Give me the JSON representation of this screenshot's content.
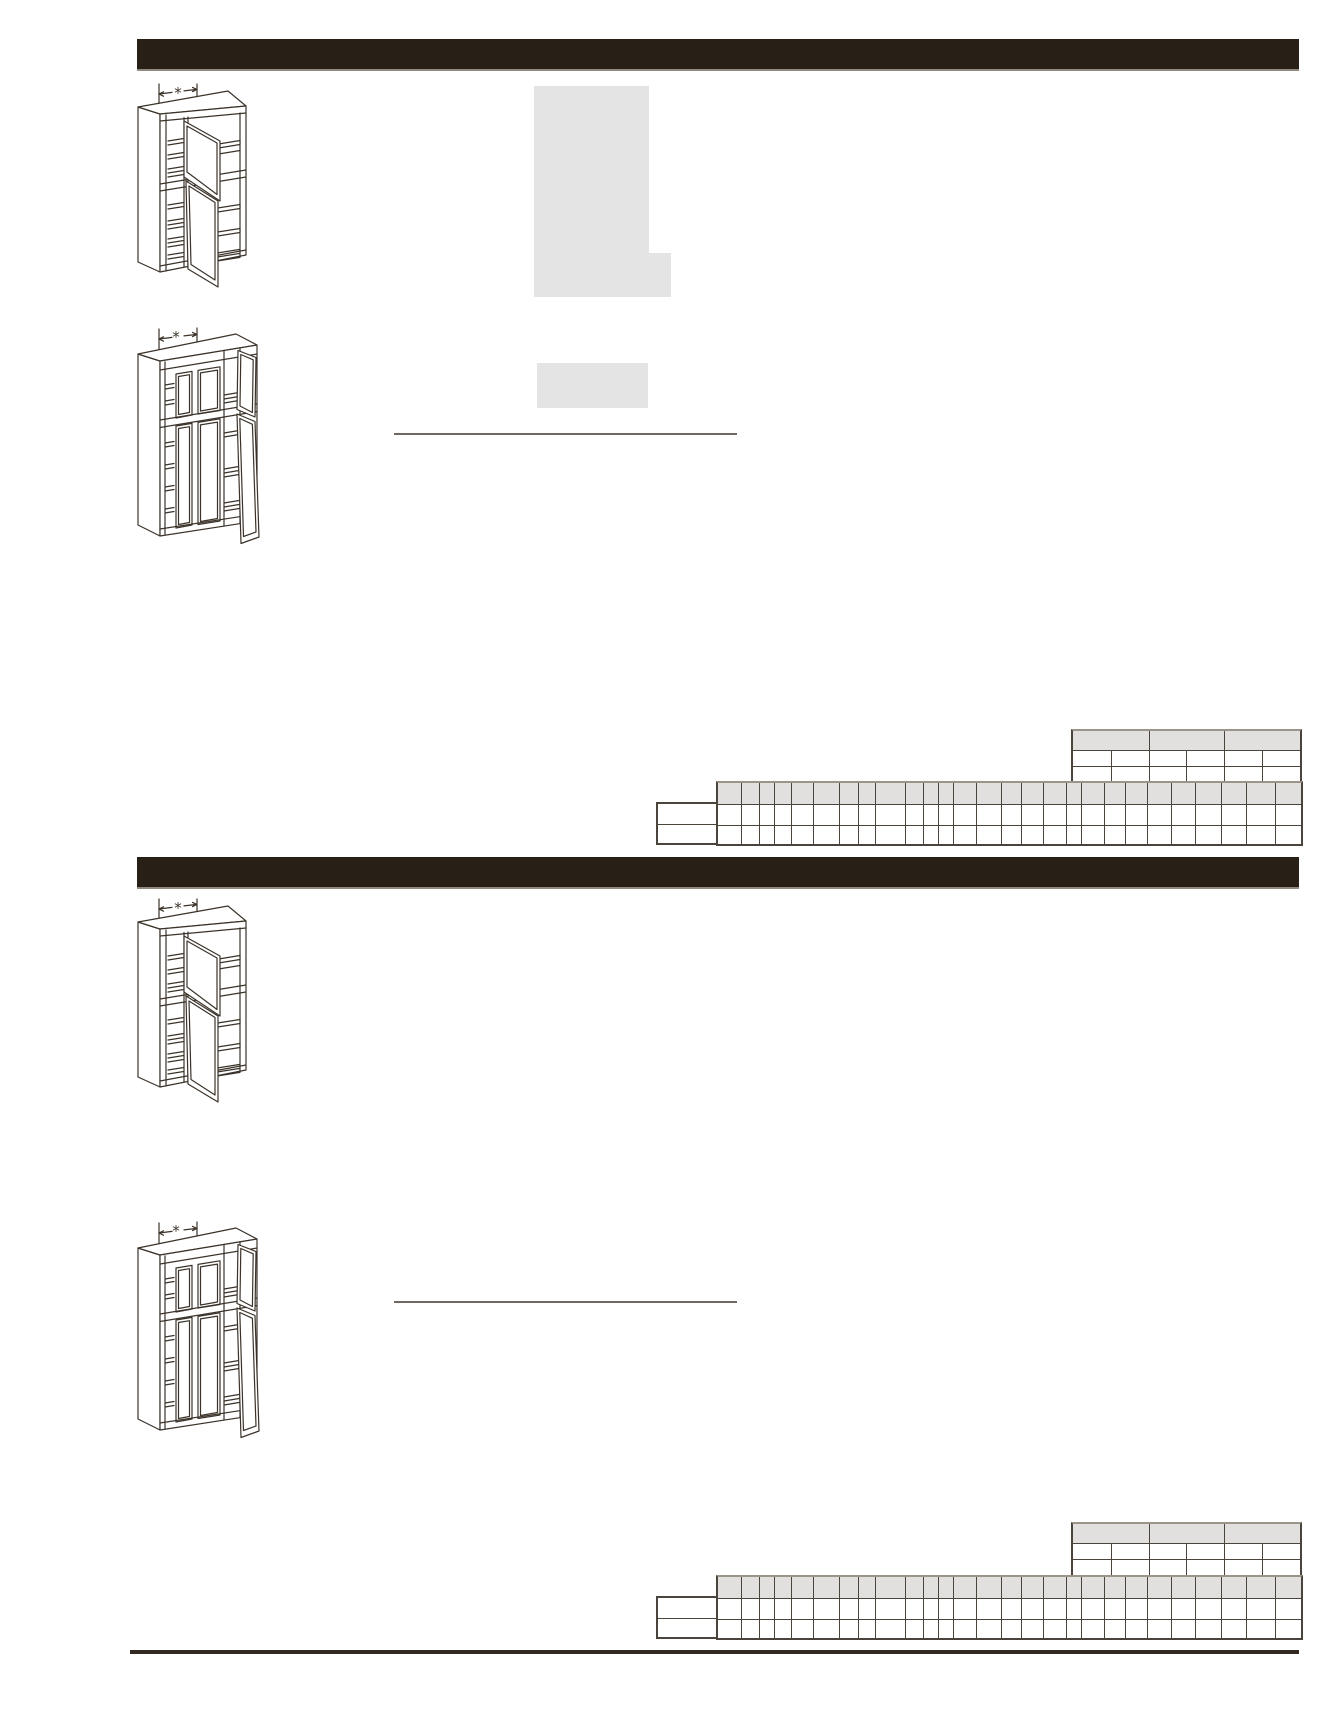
{
  "page": {
    "kind": "cabinet-catalog-spec-page",
    "background": "#ffffff",
    "dimension_star_glyph": "*"
  },
  "colors": {
    "section_bar": "#281f17",
    "bar_underline": "#8f897f",
    "placeholder_gray": "#e4e4e4",
    "table_border": "#4a443c",
    "table_header_fill": "#e1e0de",
    "table_top_edge": "#9b9589",
    "divider_line": "#6f695f",
    "footer_rule": "#322a22",
    "drawing_stroke": "#3b332a"
  },
  "sections": [
    {
      "bar_title": "",
      "illustrations": [
        {
          "kind": "blind-corner-pantry-cabinet",
          "dimension_label": "*"
        },
        {
          "kind": "utility-pantry-cabinet",
          "dimension_label": "*"
        }
      ],
      "divider_y": 433,
      "size_table_y": 729,
      "spec_table_y": 781
    },
    {
      "bar_title": "",
      "illustrations": [
        {
          "kind": "blind-corner-pantry-cabinet",
          "dimension_label": "*"
        },
        {
          "kind": "utility-pantry-cabinet",
          "dimension_label": "*"
        }
      ],
      "divider_y": 1301,
      "size_table_y": 1522,
      "spec_table_y": 1575
    }
  ],
  "size_table": {
    "x": 1071,
    "width": 227,
    "header_columns": 3,
    "body_columns": 6,
    "header_height": 19,
    "row_heights": [
      15,
      15
    ],
    "header_cells": [
      "",
      "",
      ""
    ],
    "rows": [
      [
        "",
        "",
        "",
        "",
        "",
        ""
      ],
      [
        "",
        "",
        "",
        "",
        "",
        ""
      ]
    ],
    "all_cells_blank": true
  },
  "spec_table": {
    "x": 656,
    "label_column_width": 60,
    "label_cells": [
      "",
      ""
    ],
    "grid_offset": 60,
    "grid_width": 583,
    "column_widths": [
      23,
      18,
      15,
      17,
      22,
      26,
      19,
      17,
      30,
      18,
      15,
      15,
      23,
      25,
      20,
      22,
      23,
      15,
      23,
      21,
      22,
      24,
      24,
      26,
      25,
      29,
      26
    ],
    "header_height": 21,
    "row_heights": [
      20,
      18
    ],
    "all_cells_blank": true
  }
}
